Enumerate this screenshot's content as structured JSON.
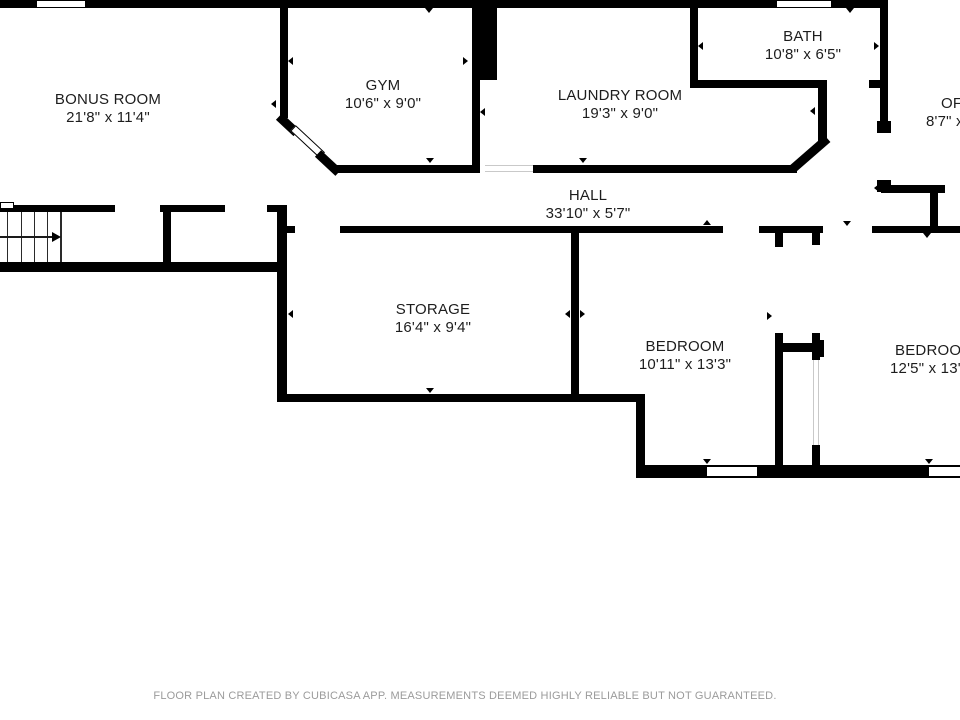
{
  "document": {
    "type": "floor-plan",
    "footer": {
      "text": "FLOOR PLAN CREATED BY CUBICASA APP. MEASUREMENTS DEEMED HIGHLY RELIABLE BUT NOT GUARANTEED."
    }
  },
  "colors": {
    "background": "#ffffff",
    "wall": "#000000",
    "room_text": "#1d1d1d",
    "footer_text": "#9b9b9b"
  },
  "icons": {
    "stairs_arrow": "right-arrow",
    "door_markers": "small-black-triangles",
    "windows": "white-rect-with-black-outline"
  },
  "rooms": [
    {
      "name": "BONUS ROOM",
      "dims": "21'8\" x 11'4\""
    },
    {
      "name": "GYM",
      "dims": "10'6\" x 9'0\""
    },
    {
      "name": "LAUNDRY ROOM",
      "dims": "19'3\" x 9'0\""
    },
    {
      "name": "BATH",
      "dims": "10'8\" x 6'5\""
    },
    {
      "name": "OFFICE",
      "dims": "8'7\" x"
    },
    {
      "name": "HALL",
      "dims": "33'10\" x 5'7\""
    },
    {
      "name": "STORAGE",
      "dims": "16'4\" x 9'4\""
    },
    {
      "name": "BEDROOM",
      "dims": "10'11\" x 13'3\""
    },
    {
      "name": "BEDROOM",
      "dims": "12'5\" x 13'3\""
    }
  ]
}
